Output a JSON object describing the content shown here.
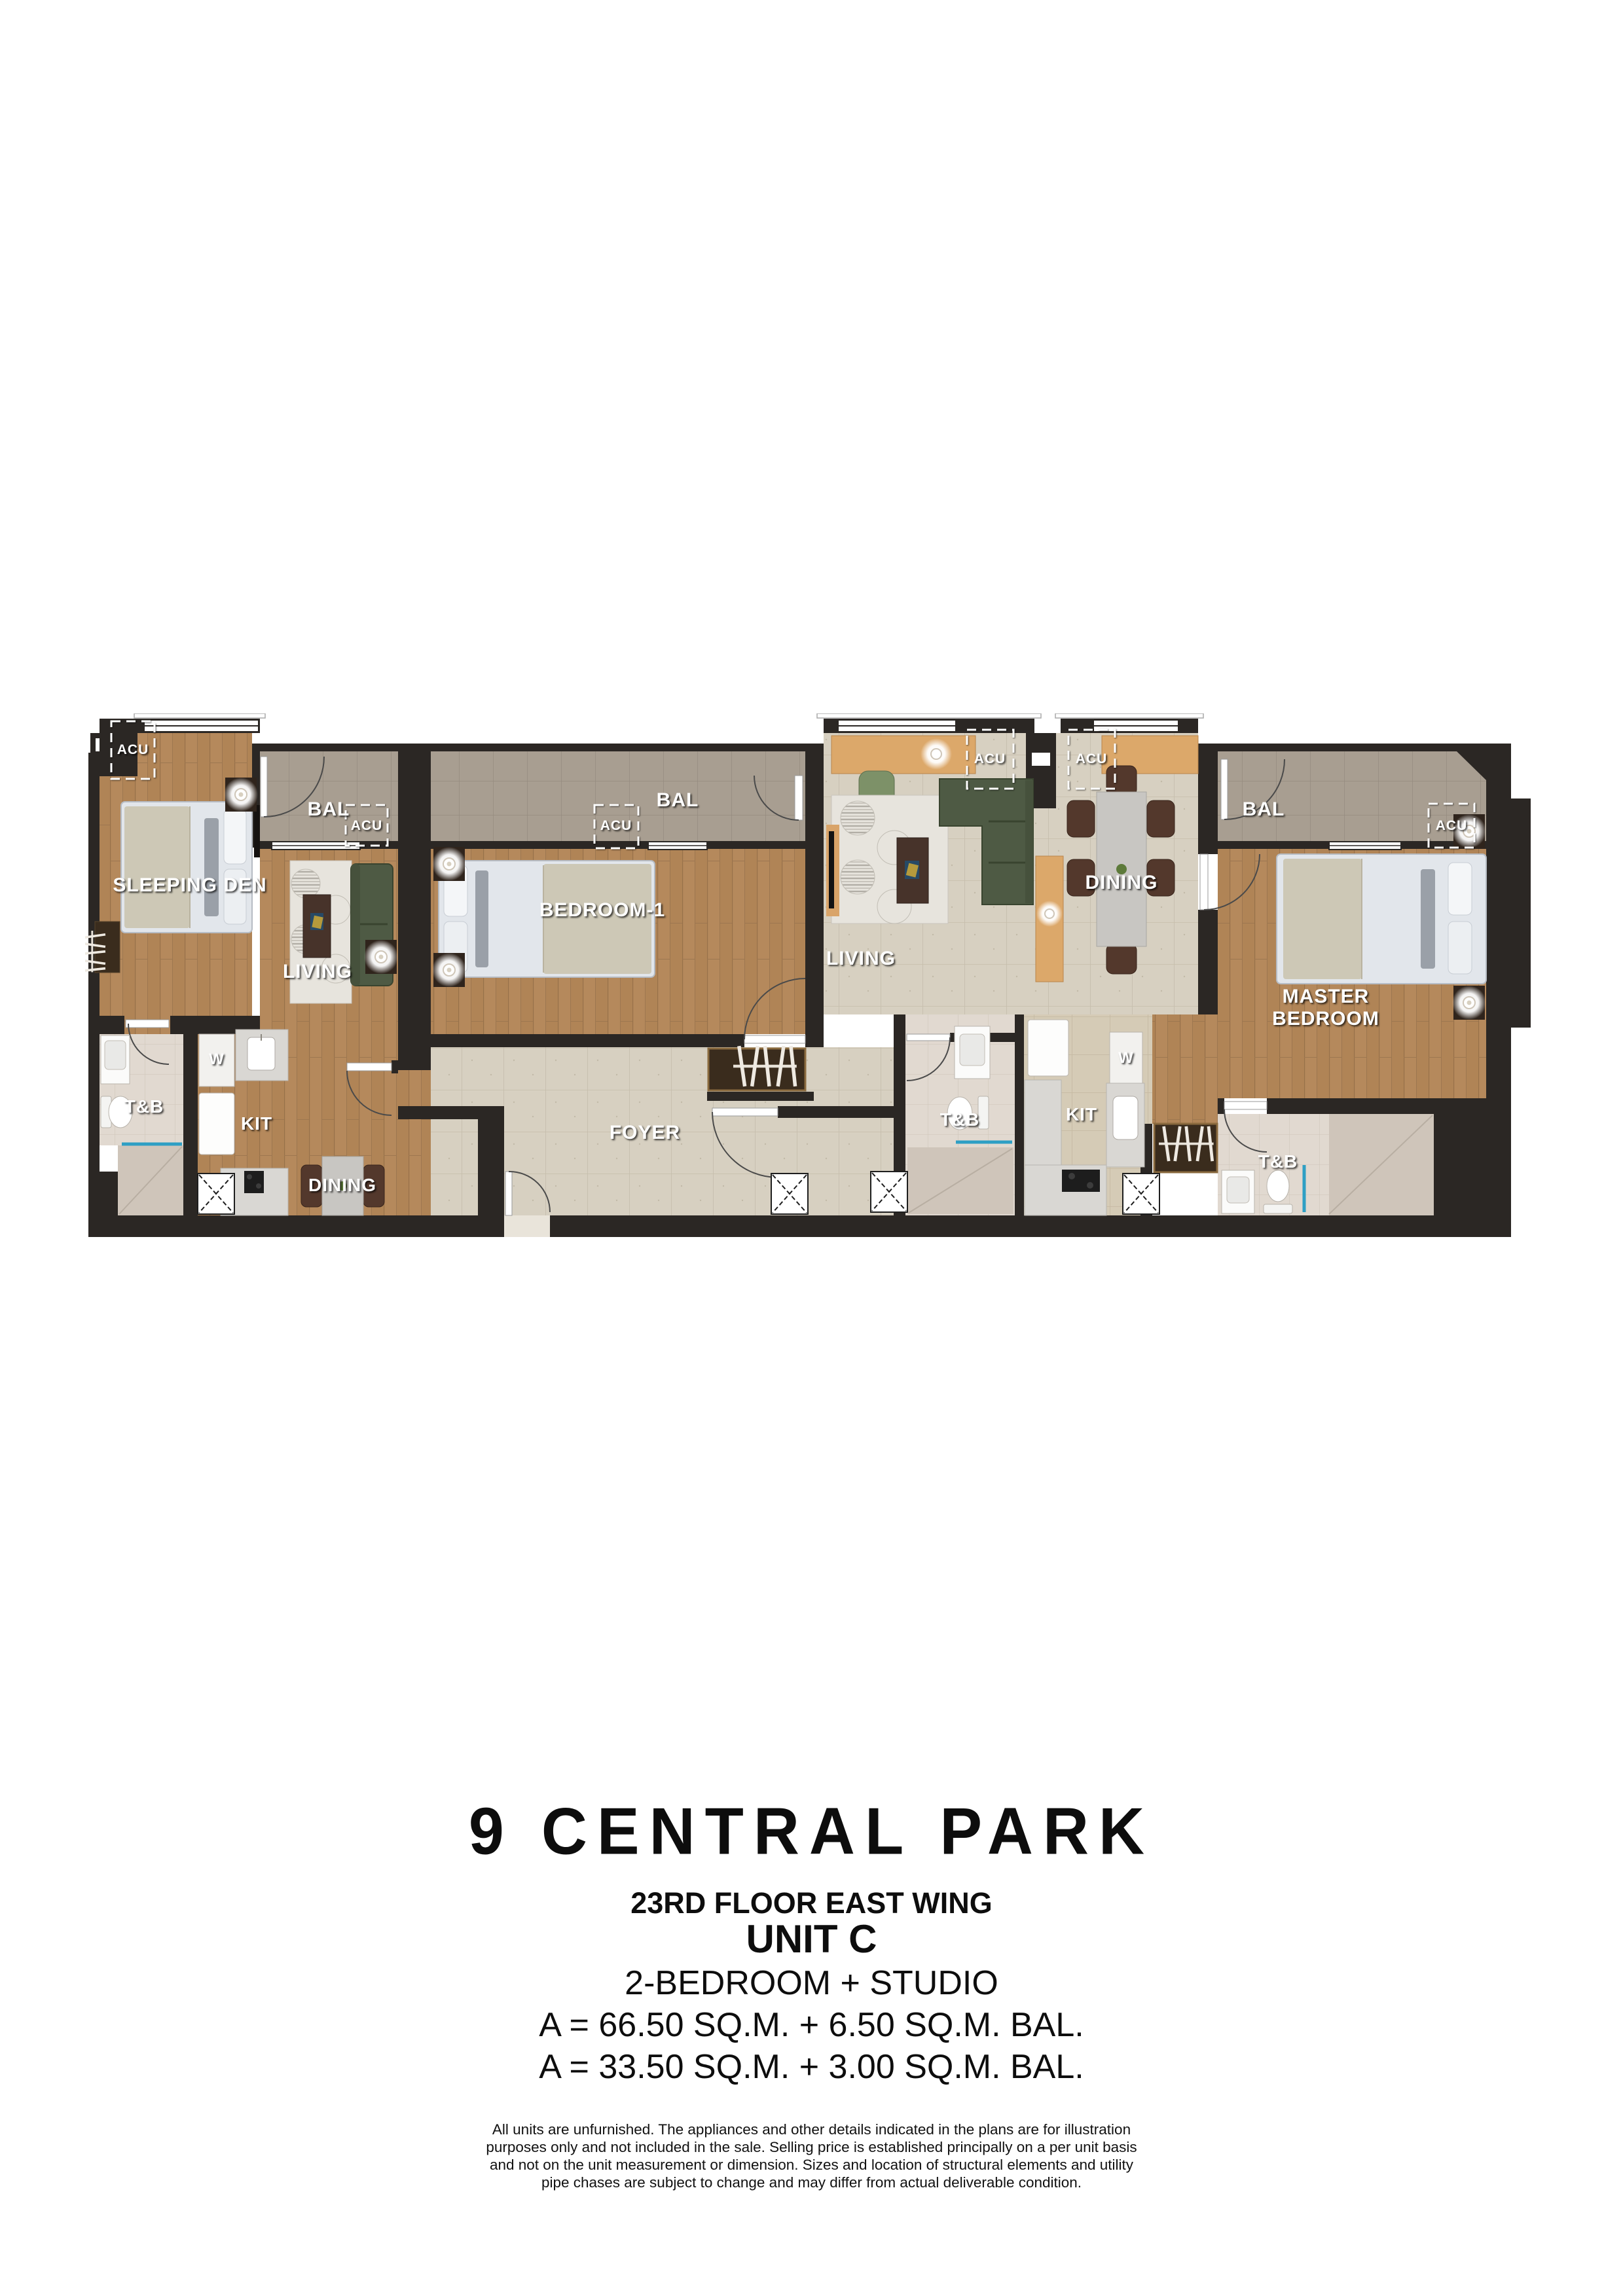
{
  "plan": {
    "labels": {
      "sleeping_den": "SLEEPING DEN",
      "bal": "BAL",
      "acu": "ACU",
      "living": "LIVING",
      "t_and_b": "T&B",
      "w": "W",
      "kit": "KIT",
      "dining": "DINING",
      "bedroom_1": "BEDROOM-1",
      "foyer": "FOYER",
      "master_line1": "MASTER",
      "master_line2": "BEDROOM"
    },
    "colors": {
      "wall": "#2b2724",
      "wood_floor": "#b5895c",
      "unit_tile": "#d7d0c1",
      "kitchen_tile": "#d5cbb8",
      "balcony_tile": "#a89e91",
      "bath_tile": "#e1d9d0",
      "sofa_green": "#4e5a44",
      "chair_brown": "#53382c",
      "accent_blue": "#2e9fc4",
      "label_white": "#ffffff"
    }
  },
  "footer": {
    "title": "9 CENTRAL PARK",
    "floor": "23RD FLOOR EAST WING",
    "unit": "UNIT C",
    "config": "2-BEDROOM + STUDIO",
    "area_a": "A = 66.50 SQ.M. + 6.50 SQ.M. BAL.",
    "area_b": "A = 33.50 SQ.M. + 3.00 SQ.M. BAL.",
    "disclaimer_lines": [
      "All units are unfurnished. The appliances and other details indicated in the plans are for illustration",
      "purposes only and not included in the sale. Selling price is established principally on a per unit basis",
      "and not on the unit measurement or dimension. Sizes and location of structural elements and utility",
      "pipe chases are subject to change and may differ from actual deliverable condition."
    ]
  }
}
